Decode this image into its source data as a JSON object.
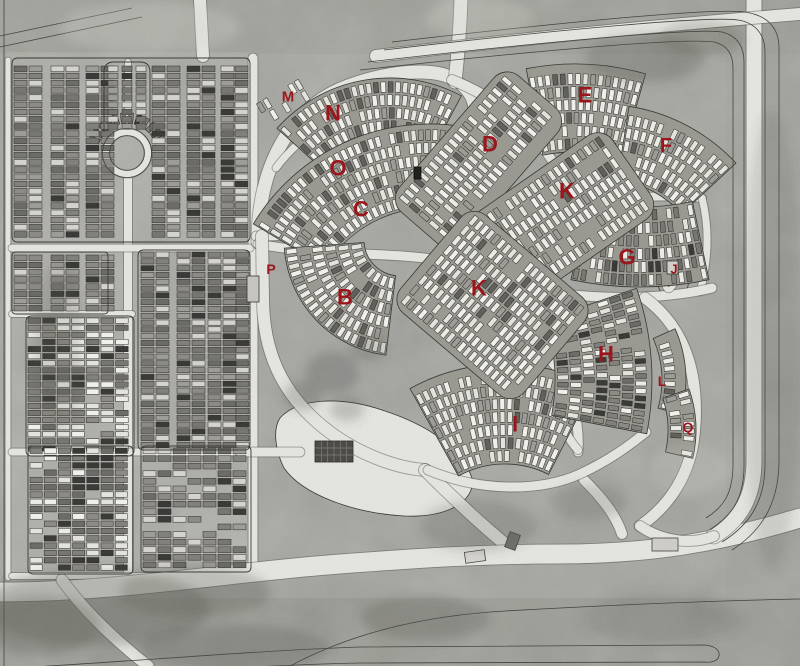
{
  "meta": {
    "description": "Grayscale aerial photograph map of a cemetery with red lettered section markers",
    "width": 800,
    "height": 666
  },
  "colors": {
    "label_red": "#9b151b",
    "road_light": "#e7e7e2",
    "road_edge": "#4b4b46",
    "bed_fill": "#97978f",
    "bed_stroke": "#2e2e2a",
    "detail_line": "#3a3a35",
    "plot_dark_shades": [
      "#7e7c77",
      "#8a8781",
      "#73716c",
      "#676560"
    ],
    "plot_white_shades": [
      "#f0efe9",
      "#e7e6e0",
      "#f5f4f0"
    ],
    "plot_light": "#d7d5cf",
    "plot_mid": "#9c9a94",
    "plot_black": "#31302d",
    "plot_shadow": "#5b5954",
    "plot_outline": "#21211e",
    "patch_dark": "#51514b"
  },
  "labels": [
    {
      "id": "m",
      "text": "M",
      "x": 288,
      "y": 97,
      "size": 15
    },
    {
      "id": "n",
      "text": "N",
      "x": 333,
      "y": 113,
      "size": 22
    },
    {
      "id": "o",
      "text": "O",
      "x": 338,
      "y": 168,
      "size": 22
    },
    {
      "id": "c",
      "text": "C",
      "x": 361,
      "y": 209,
      "size": 22
    },
    {
      "id": "d",
      "text": "D",
      "x": 490,
      "y": 144,
      "size": 22
    },
    {
      "id": "e",
      "text": "E",
      "x": 585,
      "y": 95,
      "size": 22
    },
    {
      "id": "f",
      "text": "F",
      "x": 666,
      "y": 146,
      "size": 20
    },
    {
      "id": "k-upper",
      "text": "K",
      "x": 567,
      "y": 191,
      "size": 22
    },
    {
      "id": "g",
      "text": "G",
      "x": 627,
      "y": 257,
      "size": 22
    },
    {
      "id": "j",
      "text": "J",
      "x": 674,
      "y": 269,
      "size": 13
    },
    {
      "id": "p",
      "text": "P",
      "x": 271,
      "y": 269,
      "size": 14
    },
    {
      "id": "b",
      "text": "B",
      "x": 345,
      "y": 297,
      "size": 22
    },
    {
      "id": "k-lower",
      "text": "K",
      "x": 479,
      "y": 288,
      "size": 22
    },
    {
      "id": "h",
      "text": "H",
      "x": 606,
      "y": 354,
      "size": 22
    },
    {
      "id": "l",
      "text": "L",
      "x": 662,
      "y": 381,
      "size": 14
    },
    {
      "id": "i",
      "text": "I",
      "x": 515,
      "y": 424,
      "size": 22
    },
    {
      "id": "q",
      "text": "Q",
      "x": 688,
      "y": 427,
      "size": 14
    }
  ],
  "geometry": {
    "bg": [
      {
        "x": 0,
        "y": 0,
        "w": 800,
        "h": 666,
        "fill": "#a2a29d",
        "op": 1
      },
      {
        "x": 0,
        "y": 0,
        "w": 800,
        "h": 54,
        "fill": "#96968f",
        "op": 0.45
      },
      {
        "x": 726,
        "y": 0,
        "w": 74,
        "h": 666,
        "fill": "#9e9e97",
        "op": 0.5
      },
      {
        "x": 0,
        "y": 598,
        "w": 800,
        "h": 68,
        "fill": "#8f8f88",
        "op": 0.5
      },
      {
        "x": 6,
        "y": 52,
        "w": 250,
        "h": 528,
        "fill": "#b1b1ab",
        "op": 0.55
      }
    ],
    "fills": [
      {
        "d": "M280,418 C298,398 340,396 382,410 C432,426 462,450 472,478 C476,502 446,518 404,516 C352,513 302,494 284,468 C276,452 272,430 280,418 Z",
        "fill": "#e7e7e2"
      },
      {
        "d": "M658,232 C668,228 678,230 682,238 C690,252 692,278 686,292 C680,300 668,300 662,294 C654,284 650,244 658,232 Z",
        "fill": "#a6a59e"
      }
    ],
    "roads": [
      {
        "d": "M8,60 L8,578",
        "w": 5
      },
      {
        "d": "M253,58 L253,576",
        "w": 9
      },
      {
        "d": "M128,132 L128,62",
        "w": 6
      },
      {
        "d": "M128,175 L128,578",
        "w": 8
      },
      {
        "d": "M12,248 L250,248",
        "w": 7
      },
      {
        "d": "M12,314 L132,314",
        "w": 6
      },
      {
        "d": "M12,452 L250,452",
        "w": 7
      },
      {
        "d": "M12,576 L250,576",
        "w": 6
      },
      {
        "circle": [
          127,
          153,
          21
        ],
        "w": 7
      },
      {
        "d": "M258,242 C258,170 288,108 348,86 C395,69 438,68 455,80",
        "w": 13
      },
      {
        "d": "M455,80 C472,92 479,108 470,126",
        "w": 11
      },
      {
        "d": "M455,82 C458,55 460,28 461,0",
        "w": 13
      },
      {
        "d": "M452,80 C492,96 522,120 543,148",
        "w": 10
      },
      {
        "d": "M276,168 C310,122 360,102 438,102",
        "w": 7
      },
      {
        "d": "M256,236 C330,238 390,208 432,172 C452,155 462,142 466,130",
        "w": 9
      },
      {
        "d": "M471,232 C458,185 492,148 558,148 C625,148 655,180 641,216 C628,252 575,272 528,264 C494,258 478,250 471,232 Z",
        "w": 9
      },
      {
        "d": "M480,258 L628,172",
        "w": 6
      },
      {
        "d": "M543,148 C560,170 570,188 576,206",
        "w": 9
      },
      {
        "d": "M576,206 C612,198 660,194 702,198",
        "w": 8
      },
      {
        "d": "M702,198 C710,230 708,262 700,292",
        "w": 7
      },
      {
        "d": "M566,294 C612,300 672,298 712,288",
        "w": 9
      },
      {
        "d": "M258,244 C320,256 392,252 438,260 L552,362 C570,382 580,420 578,452",
        "w": 9
      },
      {
        "d": "M262,236 L263,298 C263,352 282,390 315,420 C350,452 395,468 425,470",
        "w": 12
      },
      {
        "d": "M240,452 L300,452",
        "w": 9
      },
      {
        "d": "M425,470 C460,505 490,532 510,548",
        "w": 12
      },
      {
        "d": "M578,450 C560,430 552,400 560,370",
        "w": 8
      },
      {
        "d": "M584,480 C602,498 616,515 622,534",
        "w": 10
      },
      {
        "d": "M645,298 C688,330 700,380 694,436 C690,472 672,504 640,526",
        "w": 11
      },
      {
        "d": "M428,470 C480,492 540,492 580,474 C610,460 630,445 646,432",
        "w": 9
      },
      {
        "d": "M0,592 C120,592 230,572 340,564 C420,558 480,554 560,554 C650,554 720,542 800,518",
        "w": 19
      },
      {
        "d": "M62,580 C85,612 115,640 148,666",
        "w": 11
      },
      {
        "d": "M754,0 L754,460 C754,498 740,520 714,536",
        "w": 15
      },
      {
        "d": "M640,526 C660,540 690,546 714,536",
        "w": 10
      },
      {
        "d": "M376,56 C560,34 700,22 800,14",
        "w": 12
      },
      {
        "d": "M200,0 L203,56",
        "w": 12
      },
      {
        "ellipse": [
          672,
          263,
          8,
          27,
          8
        ],
        "w": 5
      }
    ],
    "strips": [
      {
        "x": 14,
        "w": 13,
        "y0": 66,
        "y1": 238,
        "cell": 7.2,
        "pal": "dark"
      },
      {
        "x": 29,
        "w": 13,
        "y0": 66,
        "y1": 238,
        "cell": 7.2,
        "pal": "dark"
      },
      {
        "x": 51,
        "w": 13,
        "y0": 66,
        "y1": 238,
        "cell": 7.2,
        "pal": "dark"
      },
      {
        "x": 66,
        "w": 13,
        "y0": 66,
        "y1": 238,
        "cell": 7.2,
        "pal": "dark"
      },
      {
        "x": 86,
        "w": 13,
        "y0": 66,
        "y1": 238,
        "cell": 7.2,
        "pal": "dark"
      },
      {
        "x": 101,
        "w": 13,
        "y0": 66,
        "y1": 238,
        "cell": 7.2,
        "pal": "dark"
      },
      {
        "x": 152,
        "w": 13,
        "y0": 66,
        "y1": 238,
        "cell": 7.2,
        "pal": "dark"
      },
      {
        "x": 167,
        "w": 13,
        "y0": 66,
        "y1": 238,
        "cell": 7.2,
        "pal": "dark"
      },
      {
        "x": 187,
        "w": 13,
        "y0": 66,
        "y1": 238,
        "cell": 7.2,
        "pal": "dark"
      },
      {
        "x": 202,
        "w": 13,
        "y0": 66,
        "y1": 238,
        "cell": 7.2,
        "pal": "dark"
      },
      {
        "x": 221,
        "w": 13,
        "y0": 66,
        "y1": 238,
        "cell": 7.2,
        "pal": "dark"
      },
      {
        "x": 235,
        "w": 13,
        "y0": 66,
        "y1": 238,
        "cell": 7.2,
        "pal": "dark"
      },
      {
        "x": 108,
        "w": 10,
        "y0": 66,
        "y1": 128,
        "cell": 7.2,
        "pal": "dark"
      },
      {
        "x": 122,
        "w": 10,
        "y0": 66,
        "y1": 128,
        "cell": 7.2,
        "pal": "dark"
      },
      {
        "x": 136,
        "w": 10,
        "y0": 66,
        "y1": 128,
        "cell": 7.2,
        "pal": "dark"
      },
      {
        "x": 14,
        "w": 13,
        "y0": 255,
        "y1": 312,
        "cell": 7.2,
        "pal": "dark"
      },
      {
        "x": 29,
        "w": 13,
        "y0": 255,
        "y1": 312,
        "cell": 7.2,
        "pal": "dark"
      },
      {
        "x": 51,
        "w": 13,
        "y0": 255,
        "y1": 312,
        "cell": 7.2,
        "pal": "dark"
      },
      {
        "x": 66,
        "w": 13,
        "y0": 255,
        "y1": 312,
        "cell": 7.2,
        "pal": "dark"
      },
      {
        "x": 86,
        "w": 13,
        "y0": 255,
        "y1": 312,
        "cell": 7.2,
        "pal": "dark"
      },
      {
        "x": 101,
        "w": 13,
        "y0": 255,
        "y1": 312,
        "cell": 7.2,
        "pal": "dark"
      },
      {
        "x": 141,
        "w": 13,
        "y0": 252,
        "y1": 448,
        "cell": 6.8,
        "pal": "dark"
      },
      {
        "x": 156,
        "w": 13,
        "y0": 252,
        "y1": 448,
        "cell": 6.8,
        "pal": "dark"
      },
      {
        "x": 177,
        "w": 13,
        "y0": 252,
        "y1": 448,
        "cell": 6.8,
        "pal": "dark"
      },
      {
        "x": 192,
        "w": 13,
        "y0": 252,
        "y1": 448,
        "cell": 6.8,
        "pal": "dark"
      },
      {
        "x": 208,
        "w": 13,
        "y0": 252,
        "y1": 448,
        "cell": 6.8,
        "pal": "dark"
      },
      {
        "x": 223,
        "w": 13,
        "y0": 252,
        "y1": 448,
        "cell": 6.8,
        "pal": "dark"
      },
      {
        "x": 236,
        "w": 13,
        "y0": 252,
        "y1": 448,
        "cell": 6.8,
        "pal": "dark"
      }
    ],
    "grids": [
      {
        "x0": 28,
        "y0": 318,
        "cols": 7,
        "rows": 19,
        "cw": 14.6,
        "ch": 7.1,
        "pal": "mix",
        "skip": 0.05
      },
      {
        "x0": 30,
        "y0": 448,
        "cols": 7,
        "rows": 17,
        "cw": 14.2,
        "ch": 7.3,
        "pal": "mix",
        "skip": 0.06
      },
      {
        "x0": 143,
        "y0": 448,
        "cols": 7,
        "rows": 16,
        "cw": 15,
        "ch": 7.6,
        "pal": "dark",
        "skip": 0.22
      }
    ],
    "arcs": [
      {
        "cx": 390,
        "cy": 230,
        "r0": 96,
        "r1": 152,
        "a0": 222,
        "a1": 298,
        "pal": "light",
        "skip": 0.08
      },
      {
        "cx": 430,
        "cy": 330,
        "r0": 122,
        "r1": 206,
        "a0": 211,
        "a1": 279,
        "pal": "light",
        "skip": 0.08
      },
      {
        "cx": 575,
        "cy": 320,
        "r0": 168,
        "r1": 256,
        "a0": 259,
        "a1": 286,
        "pal": "light",
        "skip": 0.08
      },
      {
        "cx": 600,
        "cy": 290,
        "r0": 112,
        "r1": 186,
        "a0": 279,
        "a1": 317,
        "pal": "light",
        "skip": 0.1
      },
      {
        "cx": 400,
        "cy": 240,
        "r0": 36,
        "r1": 116,
        "a0": 97,
        "a1": 176,
        "pal": "light",
        "skip": 0.1
      },
      {
        "cx": 505,
        "cy": 560,
        "r0": 96,
        "r1": 196,
        "a0": 241,
        "a1": 297,
        "pal": "light",
        "skip": 0.08
      },
      {
        "cx": 560,
        "cy": 380,
        "r0": 102,
        "r1": 126,
        "a0": 336,
        "a1": 376,
        "pal": "light",
        "skip": 0.25
      },
      {
        "cx": 570,
        "cy": 430,
        "r0": 98,
        "r1": 126,
        "a0": 341,
        "a1": 373,
        "pal": "light",
        "skip": 0.3
      },
      {
        "cx": 370,
        "cy": 380,
        "r0": 185,
        "r1": 282,
        "a0": 341,
        "a1": 371,
        "pal": "mix",
        "skip": 0.1
      },
      {
        "cx": 640,
        "cy": -45,
        "r0": 252,
        "r1": 332,
        "a0": 78,
        "a1": 102,
        "pal": "mix",
        "skip": 0.12
      },
      {
        "cx": 127,
        "cy": 153,
        "r0": 27,
        "r1": 44,
        "a0": 196,
        "a1": 344,
        "pal": "dark",
        "skip": 0,
        "nobed": true
      }
    ],
    "linears": [
      {
        "x0": 425,
        "y0": 222,
        "x1": 532,
        "y1": 98,
        "width": 74,
        "pal": "light",
        "skip": 0.1
      },
      {
        "x0": 487,
        "y0": 268,
        "x1": 625,
        "y1": 172,
        "width": 92,
        "pal": "light",
        "skip": 0.12
      },
      {
        "x0": 437,
        "y0": 258,
        "x1": 548,
        "y1": 352,
        "width": 118,
        "pal": "light",
        "skip": 0.1
      },
      {
        "x0": 262,
        "y0": 116,
        "x1": 306,
        "y1": 90,
        "width": 30,
        "pal": "light",
        "skip": 0.45,
        "nobed": true
      }
    ],
    "outlines": [
      "M18,58 H244 Q250,58 250,64 V236 Q250,242 244,242 H18 Q12,242 12,236 V64 Q12,58 18,58 Z",
      "M16,252 H104 Q108,252 108,256 V310 Q108,314 104,314 H16 Q12,314 12,310 V256 Q12,252 16,252 Z",
      "M32,316 H128 Q134,316 134,322 V450 Q134,456 128,456 H32 Q26,456 26,450 V322 Q26,316 32,316 Z",
      "M144,250 H244 Q250,250 250,256 V444 Q250,450 244,450 H144 Q138,450 138,444 V256 Q138,250 144,250 Z",
      "M34,446 H128 Q133,446 133,451 V569 Q133,574 128,574 H34 Q28,574 28,569 V451 Q28,446 34,446 Z",
      "M147,446 H246 Q251,446 251,451 V567 Q251,572 246,572 H147 Q141,572 141,567 V451 Q141,446 147,446 Z",
      "M104,132 V72 Q104,62 114,62 H140 Q150,62 150,72 V132"
    ],
    "details": [
      {
        "d": "M368,62 C560,40 700,28 722,32 C738,36 744,47 744,62 L744,466 C744,498 732,516 710,530"
      },
      {
        "d": "M360,70 C560,48 688,38 714,42 C727,45 733,54 733,68 L733,464 C733,492 725,506 706,518"
      },
      {
        "d": "M384,50 C572,28 712,16 738,20 C757,23 765,36 765,52 L765,464 C765,500 751,524 722,542"
      },
      {
        "d": "M392,42 C575,21 715,8 745,12 C770,16 779,30 779,48 L779,460 C779,502 763,530 732,550"
      },
      {
        "d": "M4,0 V666"
      },
      {
        "d": "M0,36 L132,8"
      },
      {
        "d": "M0,47 L142,17"
      },
      {
        "d": "M0,669 C140,661 250,651 360,647 L705,645 C716,646 720,651 719,656 C718,661 711,663 705,662 L360,663 C250,665 140,675 0,683"
      },
      {
        "d": "M290,666 C350,634 420,616 505,611 C610,605 700,601 800,599"
      },
      {
        "circle": [
          127,
          153,
          24.5
        ]
      },
      {
        "circle": [
          127,
          153,
          17.5
        ]
      }
    ],
    "structures": [
      {
        "x": 315,
        "y": 441,
        "w": 38,
        "h": 21,
        "fill": "#45433e",
        "stroke": "#1e1e1c",
        "grid": [
          6,
          3
        ],
        "rot": 0
      },
      {
        "x": 247,
        "y": 276,
        "w": 12,
        "h": 26,
        "fill": "#c7c6c0",
        "stroke": "#2c2c28",
        "rot": 0
      },
      {
        "x": 465,
        "y": 551,
        "w": 20,
        "h": 11,
        "fill": "#d8d7d1",
        "stroke": "#3a3a36",
        "rot": -8
      },
      {
        "x": 507,
        "y": 533,
        "w": 11,
        "h": 16,
        "fill": "#6e6c66",
        "stroke": "#3a3a36",
        "rot": 20
      },
      {
        "x": 652,
        "y": 538,
        "w": 26,
        "h": 13,
        "fill": "#cfceca",
        "stroke": "#3a3a36",
        "rot": 0
      },
      {
        "x": 667,
        "y": 261,
        "w": 11,
        "h": 13,
        "fill": "#d3d2cc",
        "stroke": "#2c2c28",
        "rot": 0
      },
      {
        "x": 414,
        "y": 167,
        "w": 7,
        "h": 12,
        "fill": "#141412",
        "stroke": "#000000",
        "rot": 0
      }
    ],
    "patches": [
      [
        95,
        608,
        115,
        38,
        0.33
      ],
      [
        235,
        648,
        95,
        24,
        0.3
      ],
      [
        332,
        372,
        27,
        21,
        0.3
      ],
      [
        302,
        396,
        19,
        15,
        0.28
      ],
      [
        347,
        409,
        17,
        12,
        0.26
      ],
      [
        478,
        526,
        58,
        26,
        0.22
      ],
      [
        645,
        58,
        60,
        24,
        0.28
      ],
      [
        702,
        38,
        42,
        18,
        0.22
      ],
      [
        58,
        345,
        24,
        85,
        0.18
      ],
      [
        772,
        340,
        30,
        230,
        0.16
      ],
      [
        588,
        502,
        38,
        18,
        0.22
      ],
      [
        425,
        618,
        65,
        22,
        0.28
      ],
      [
        195,
        592,
        75,
        26,
        0.26
      ],
      [
        368,
        348,
        18,
        14,
        0.26
      ],
      [
        40,
        625,
        60,
        30,
        0.28
      ],
      [
        660,
        618,
        80,
        25,
        0.16
      ],
      [
        150,
        28,
        90,
        26,
        0.28,
        "#d8d6d0"
      ],
      [
        480,
        18,
        55,
        20,
        0.25,
        "#d8d6d0"
      ],
      [
        690,
        470,
        40,
        25,
        0.18,
        "#d8d6d0"
      ]
    ]
  }
}
